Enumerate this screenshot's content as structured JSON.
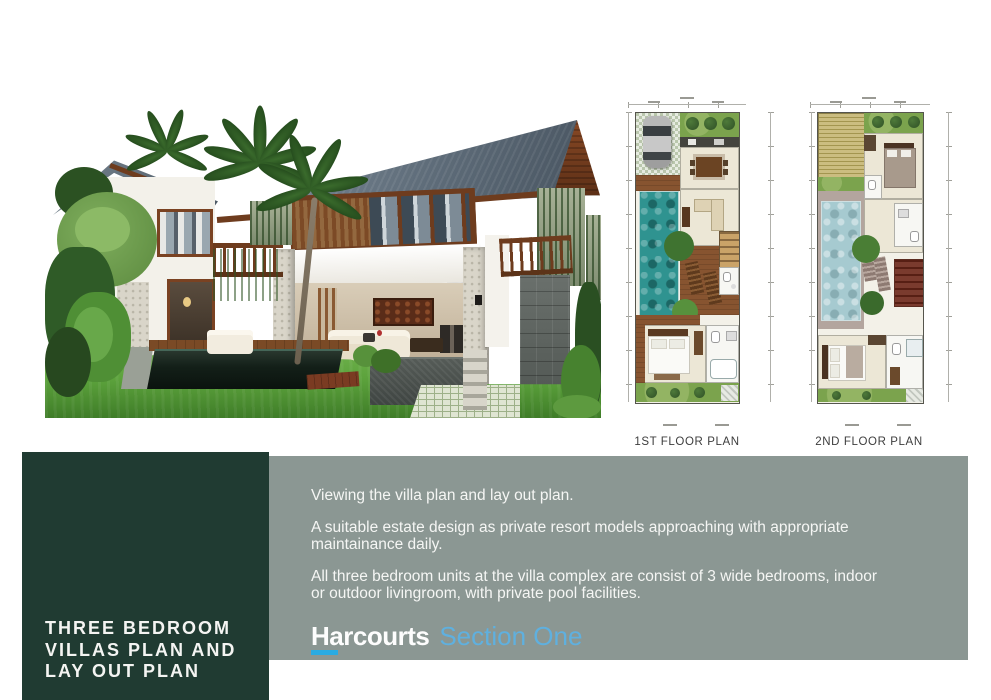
{
  "plans": [
    {
      "label": "1ST FLOOR PLAN"
    },
    {
      "label": "2ND FLOOR PLAN"
    }
  ],
  "banner": {
    "title_lines": [
      "THREE BEDROOM",
      "VILLAS PLAN AND",
      "LAY OUT PLAN"
    ],
    "paragraphs": [
      "Viewing the villa plan and lay out plan.",
      "A suitable estate design as private resort models approaching with appropriate\nmaintainance daily.",
      "All three bedroom units at the villa complex are consist of 3 wide bedrooms, indoor\nor outdoor livingroom, with private pool facilities."
    ],
    "logo": {
      "brand": "Harcourts",
      "division": "Section One"
    }
  },
  "colors": {
    "panel_dark": "#203b32",
    "panel_gray": "#8b9793",
    "text_light": "#f5f6f4",
    "logo_blue": "#2aabe2",
    "logo_division": "#5fb0df",
    "label_dark": "#3d3d3d",
    "pool_teal": "#2f9390",
    "pool_soft": "#a6cad0",
    "roof_slate": "#5d6b78",
    "grass_green": "#5ca23c"
  }
}
